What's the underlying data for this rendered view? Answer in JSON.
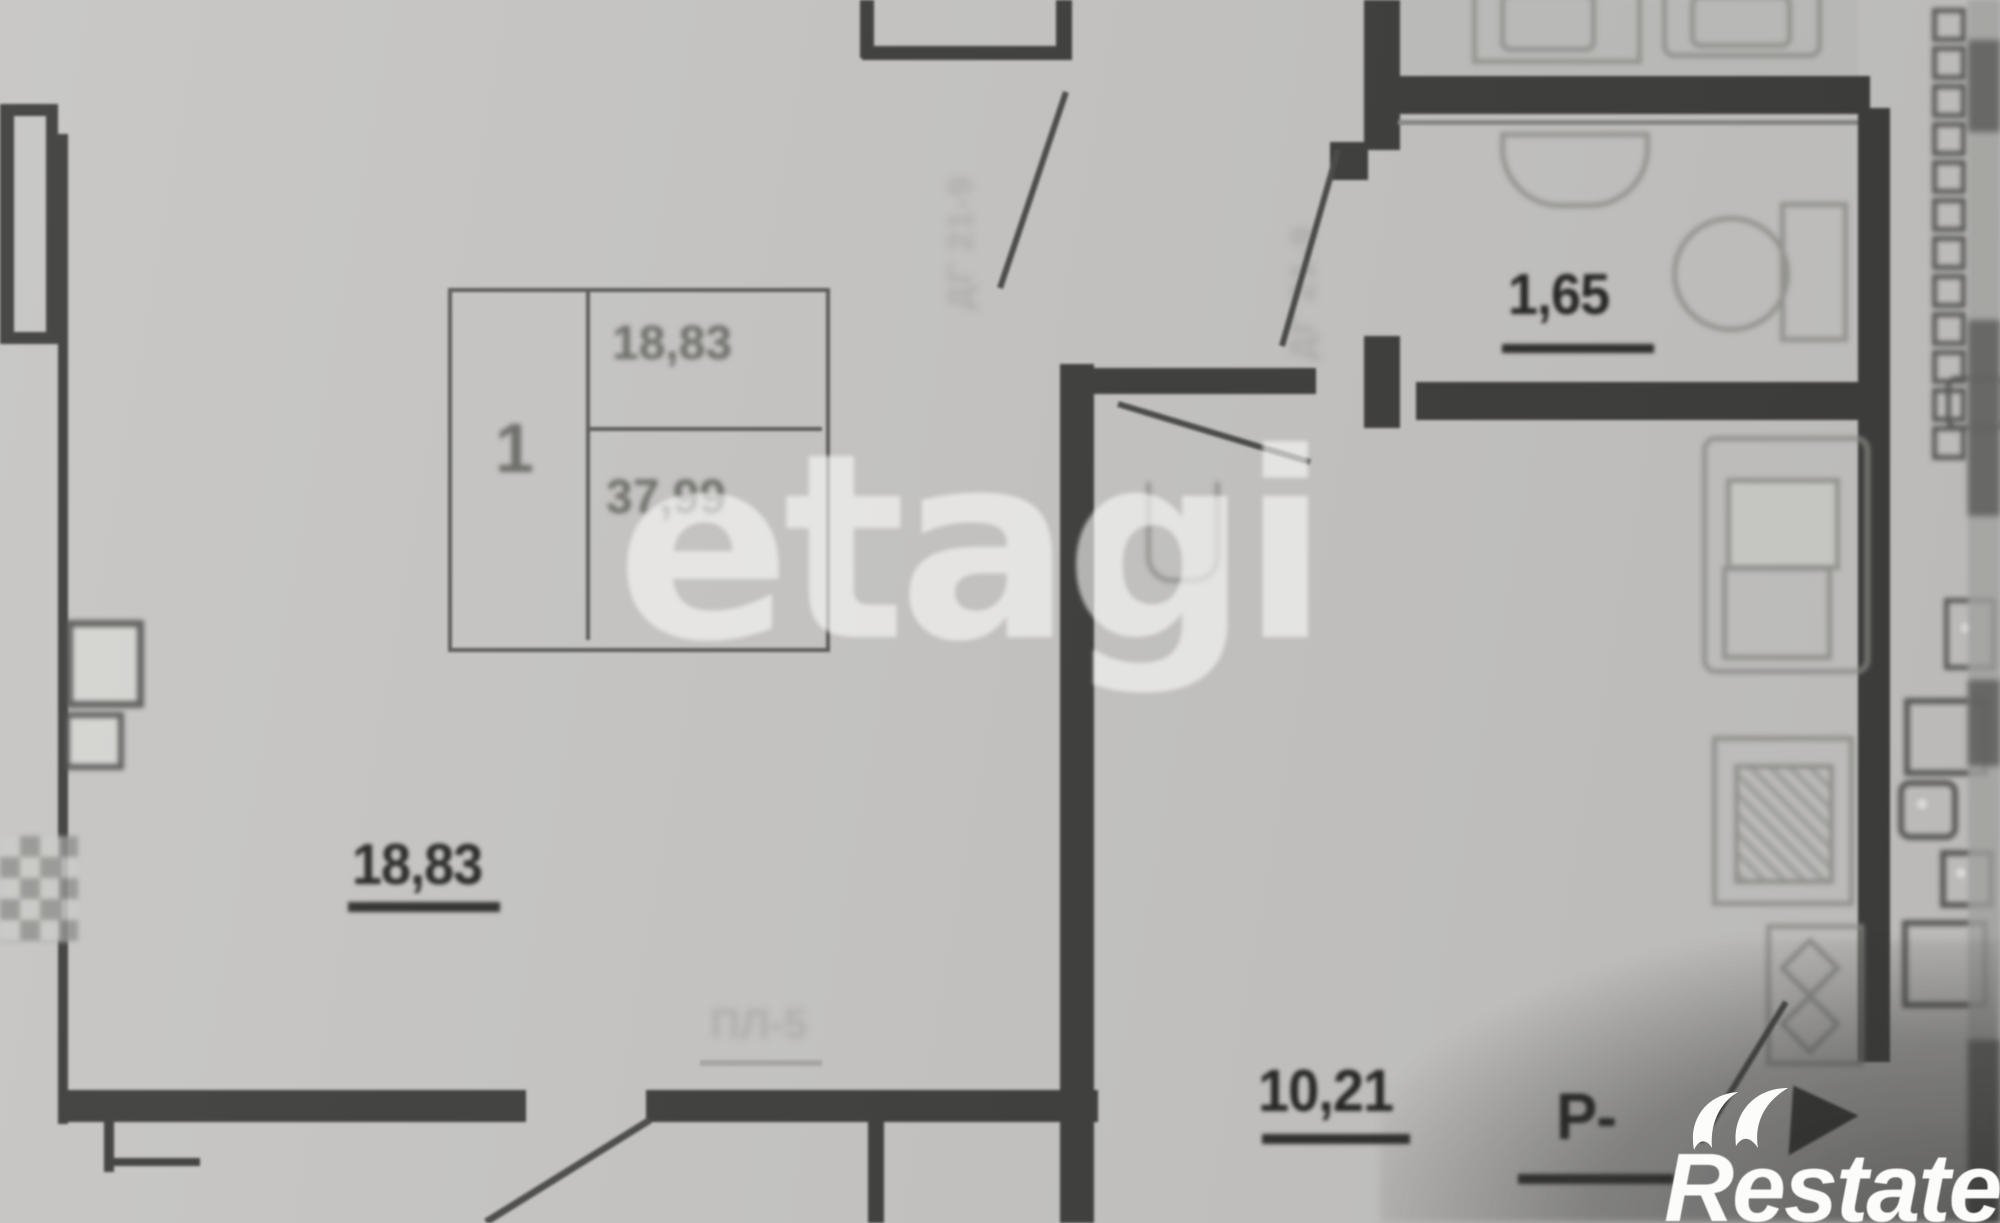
{
  "watermark": {
    "text": "etagi"
  },
  "brand": {
    "name": "Restate"
  },
  "stamp_table": {
    "room_count": "1",
    "living_area": "18,83",
    "total_area": "37,99"
  },
  "rooms": {
    "living": {
      "area": "18,83"
    },
    "hall": {
      "area": "10,21"
    },
    "wc": {
      "area": "1,65"
    }
  },
  "marks": {
    "r_mark": "Р-",
    "panel_mark": "ПЛ-5",
    "door_mark_top": "ДГ 21-9",
    "door_mark_hall": "ДГ 21-9"
  },
  "colors": {
    "paper": "#c6c5c3",
    "wall": "#3e3e3c",
    "watermark": "#fafaf8",
    "label": "#242422",
    "logo": "#fcfcfb"
  }
}
